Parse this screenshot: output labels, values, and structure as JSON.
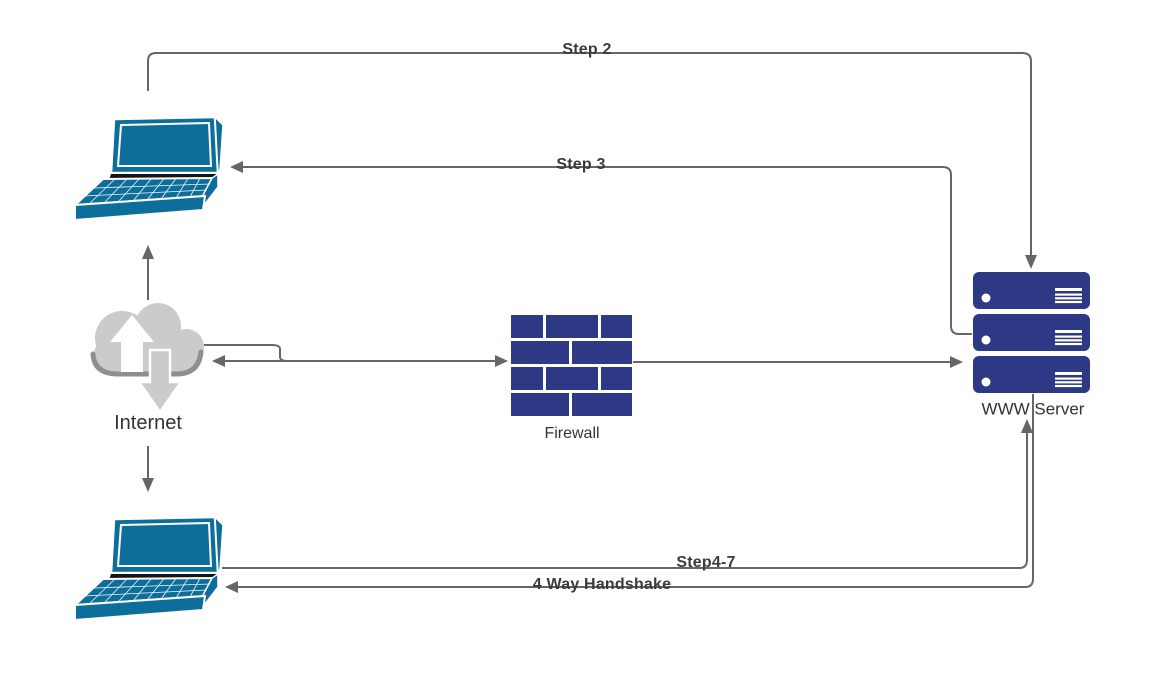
{
  "diagram": {
    "type": "network-flow-diagram",
    "background": "#ffffff",
    "colors": {
      "node_navy": "#2e3985",
      "laptop_blue": "#0d6e9c",
      "cloud_gray": "#cbcbcb",
      "cloud_shadow_gray": "#8f8f8f",
      "connector_gray": "#666666",
      "connector_label_color": "#3b3b3b",
      "node_label_color": "#333333"
    },
    "nodes": {
      "laptop_top": {
        "icon": "laptop-icon",
        "label": ""
      },
      "internet": {
        "icon": "cloud-internet-icon",
        "label": "Internet"
      },
      "laptop_bottom": {
        "icon": "laptop-icon",
        "label": ""
      },
      "firewall": {
        "icon": "firewall-brick-icon",
        "label": "Firewall"
      },
      "www_server": {
        "icon": "server-stack-icon",
        "label": "WWW Server"
      }
    },
    "connectors": {
      "step2": {
        "label": "Step 2"
      },
      "step3": {
        "label": "Step 3"
      },
      "step4_7": {
        "label": "Step4-7"
      },
      "four_way_handshake": {
        "label": "4 Way Handshake"
      },
      "internet_to_top_laptop": {
        "label": ""
      },
      "internet_to_bottom_laptop": {
        "label": ""
      },
      "internet_firewall_server": {
        "label": ""
      }
    }
  }
}
